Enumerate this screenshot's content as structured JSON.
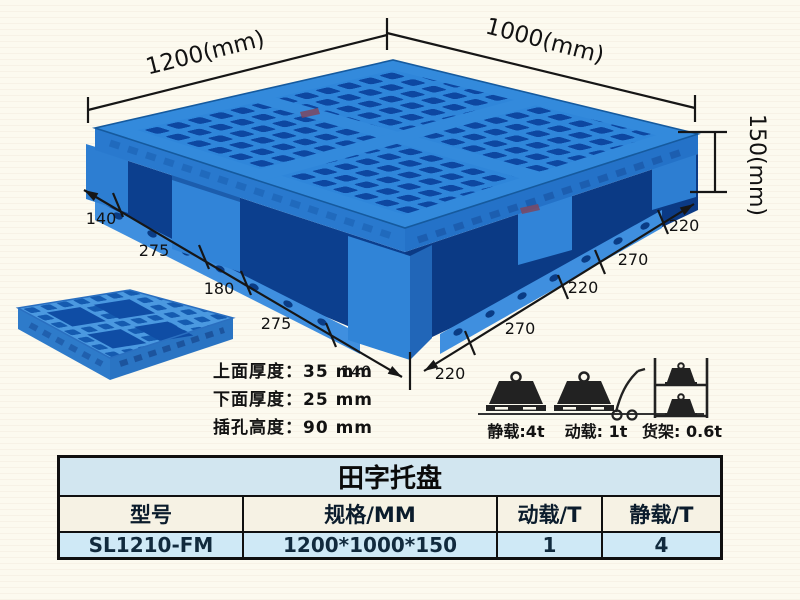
{
  "page": {
    "background": "#fcfaef"
  },
  "colors": {
    "pallet_blue": "#2f86da",
    "pallet_hole_blue": "#0d47a1",
    "pallet_side_blue": "#2979ce",
    "dim_line": "#161616",
    "table_title_bg": "#d2e6f0",
    "table_header_bg": "#f6f2e4",
    "table_data_bg": "#cfe9f6",
    "table_border": "#101010"
  },
  "diagram": {
    "top_width_label": "1200(mm)",
    "top_depth_label": "1000(mm)",
    "height_label": "150(mm)",
    "left_chain": [
      "140",
      "275",
      "180",
      "275",
      "140"
    ],
    "right_chain": [
      "220",
      "270",
      "220",
      "270",
      "220"
    ],
    "specs": [
      "上面厚度：35 mm",
      "下面厚度：25 mm",
      "插孔高度：90 mm"
    ],
    "loads": [
      {
        "name": "static-load",
        "label": "静载:4t"
      },
      {
        "name": "dynamic-load",
        "label": "动载: 1t"
      },
      {
        "name": "rack-load",
        "label": "货架: 0.6t"
      }
    ]
  },
  "table": {
    "title": "田字托盘",
    "headers": [
      "型号",
      "规格/MM",
      "动载/T",
      "静载/T"
    ],
    "row": [
      "SL1210-FM",
      "1200*1000*150",
      "1",
      "4"
    ]
  }
}
